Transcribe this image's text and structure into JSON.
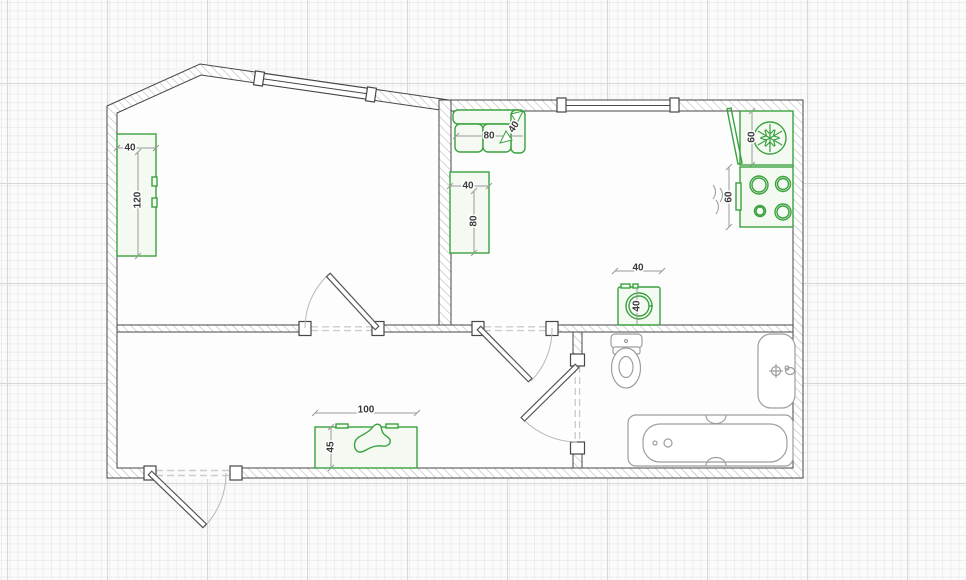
{
  "canvas": {
    "type": "floor-plan-editor-canvas",
    "colors": {
      "furniture_accent": "#3aa13f",
      "wall_outline": "#474747",
      "fixture_gray": "#9e9e9e",
      "grid_minor": "#ededed",
      "grid_major": "#d7d7d7",
      "background": "#fbfbfb",
      "floor": "#fdfdfd",
      "dimension_text": "#3a3a3a"
    }
  },
  "labels": {
    "wardrobe": {
      "width": "40",
      "height": "120"
    },
    "sofa": {
      "width": "80",
      "depth": "40"
    },
    "desk": {
      "width": "40",
      "height": "80"
    },
    "fridge": {
      "height": "60"
    },
    "stove": {
      "height": "60"
    },
    "washing_machine": {
      "width": "40",
      "depth": "40"
    },
    "shoe_cabinet": {
      "width": "100",
      "depth": "45"
    }
  },
  "furniture": [
    {
      "name": "wardrobe",
      "icon": "wardrobe-rect"
    },
    {
      "name": "sofa",
      "icon": "sofa-icon"
    },
    {
      "name": "desk",
      "icon": "desk-rect"
    },
    {
      "name": "fridge",
      "icon": "snowflake-icon"
    },
    {
      "name": "stove",
      "icon": "burner-rings-icon"
    },
    {
      "name": "washing-machine",
      "icon": "washer-drum-icon"
    },
    {
      "name": "shoe-cabinet",
      "icon": "shoe-icon"
    }
  ],
  "fixtures": [
    {
      "name": "toilet"
    },
    {
      "name": "sink",
      "icon": "faucet-icon"
    },
    {
      "name": "bathtub"
    }
  ],
  "openings": [
    {
      "name": "entrance-door"
    },
    {
      "name": "left-room-door"
    },
    {
      "name": "hallway-door"
    },
    {
      "name": "bathroom-door"
    },
    {
      "name": "slant-wall-window"
    },
    {
      "name": "kitchen-window"
    }
  ]
}
